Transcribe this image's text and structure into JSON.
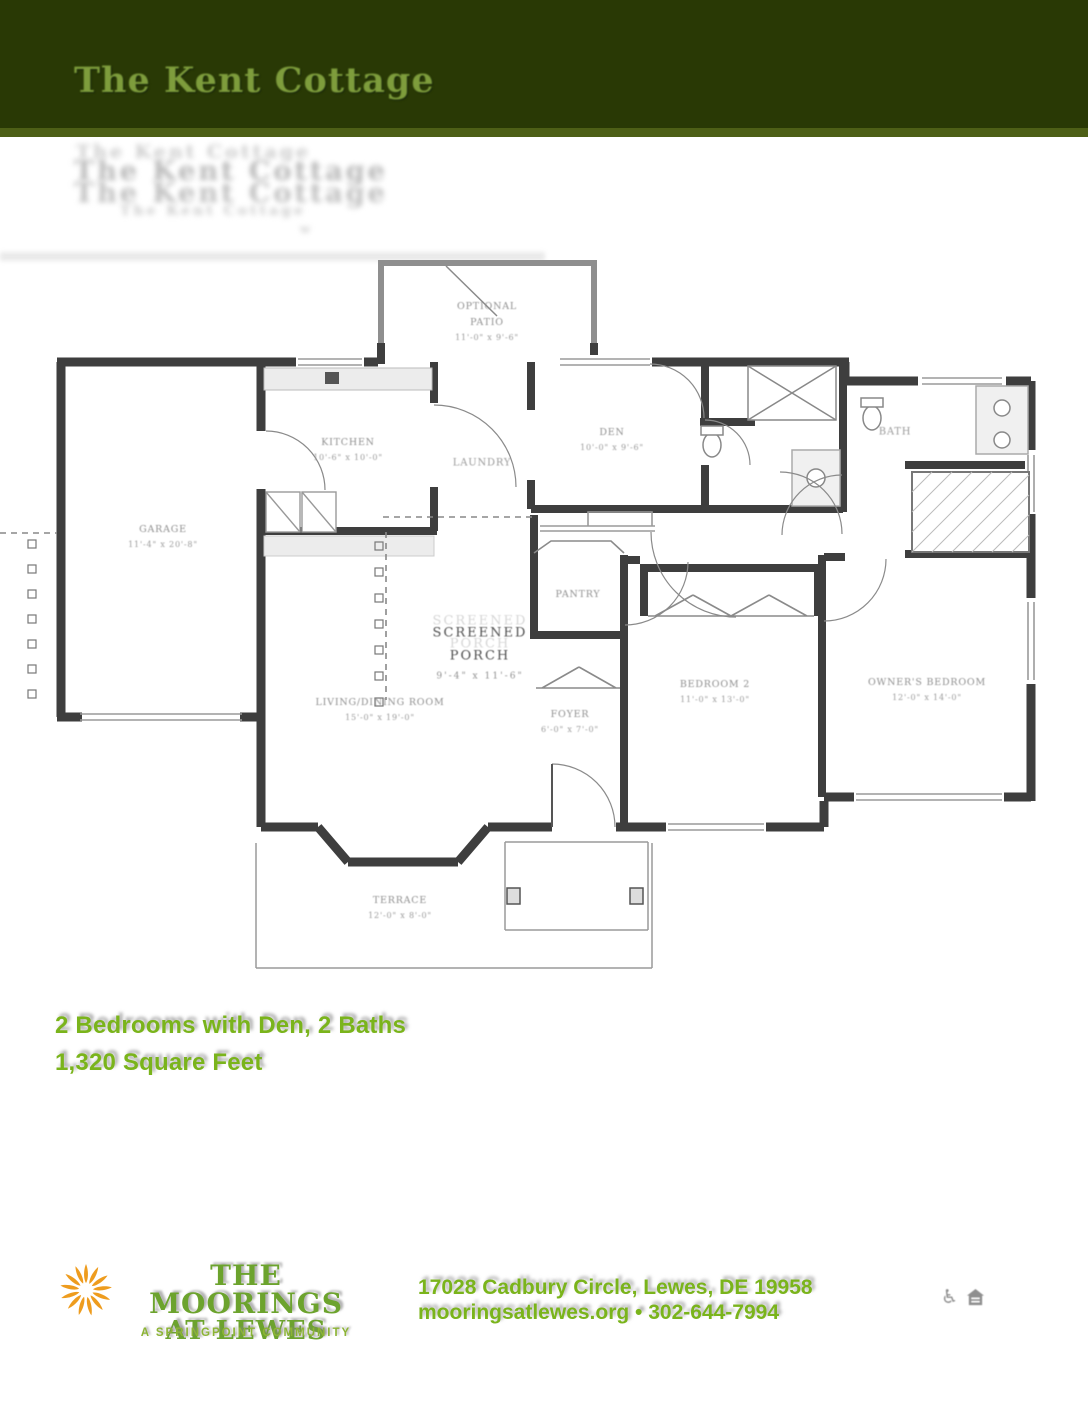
{
  "header": {
    "title": "The Kent Cottage",
    "ghost_lines": [
      "The Kent Cottage",
      "The Kent Cottage",
      "The Kent Cottage",
      "The Kent Cottage",
      "w"
    ]
  },
  "specs": {
    "line1": "2 Bedrooms with Den, 2 Baths",
    "line2": "1,320 Square Feet"
  },
  "floorplan": {
    "rooms": [
      {
        "name": "garage",
        "x": 163,
        "y": 287,
        "lines": [
          "GARAGE",
          "11'-4\" x 20'-8\""
        ]
      },
      {
        "name": "kitchen",
        "x": 348,
        "y": 200,
        "lines": [
          "KITCHEN",
          "10'-6\" x 10'-0\""
        ]
      },
      {
        "name": "laundry",
        "x": 482,
        "y": 213,
        "style": "mid",
        "lines": [
          "LAUNDRY"
        ]
      },
      {
        "name": "den",
        "x": 612,
        "y": 190,
        "lines": [
          "DEN",
          "10'-0\" x 9'-6\""
        ]
      },
      {
        "name": "bath",
        "x": 895,
        "y": 182,
        "style": "mid",
        "lines": [
          "BATH"
        ]
      },
      {
        "name": "pantry",
        "x": 578,
        "y": 345,
        "lines": [
          "PANTRY"
        ]
      },
      {
        "name": "foyer",
        "x": 570,
        "y": 472,
        "lines": [
          "FOYER",
          "6'-0\" x 7'-0\""
        ]
      },
      {
        "name": "living-dining-room",
        "x": 380,
        "y": 460,
        "lines": [
          "LIVING/DINING ROOM",
          "15'-0\" x 19'-0\""
        ]
      },
      {
        "name": "screened-porch",
        "x": 480,
        "y": 403,
        "style": "big",
        "lines": [
          "SCREENED",
          "PORCH",
          "9'-4\" x 11'-6\""
        ]
      },
      {
        "name": "bedroom-2",
        "x": 715,
        "y": 442,
        "lines": [
          "BEDROOM 2",
          "11'-0\" x 13'-0\""
        ]
      },
      {
        "name": "owners-bedroom",
        "x": 927,
        "y": 440,
        "lines": [
          "OWNER'S BEDROOM",
          "12'-0\" x 14'-0\""
        ]
      },
      {
        "name": "terrace",
        "x": 400,
        "y": 658,
        "lines": [
          "TERRACE",
          "12'-0\" x 8'-0\""
        ]
      },
      {
        "name": "optional-patio",
        "x": 487,
        "y": 72,
        "lines": [
          "OPTIONAL",
          "PATIO",
          "11'-0\" x 9'-6\""
        ]
      }
    ]
  },
  "footer": {
    "logo_line1": "THE MOORINGS",
    "logo_line2": "AT LEWES",
    "tagline": "A SPRINGPOINT COMMUNITY",
    "address": "17028 Cadbury Circle, Lewes, DE 19958",
    "contact": "mooringsatlewes.org • 302-644-7994",
    "icons": [
      "wheelchair-accessible-icon",
      "equal-housing-icon"
    ]
  },
  "colors": {
    "header_bg": "#293905",
    "header_title": "#7e9d3c",
    "accent_green": "#7ab41b",
    "logo_green": "#6ca32d",
    "tagline_green": "#8cb434",
    "sunburst_orange": "#ee9c1e",
    "wall_gray": "#3e3e3e"
  }
}
